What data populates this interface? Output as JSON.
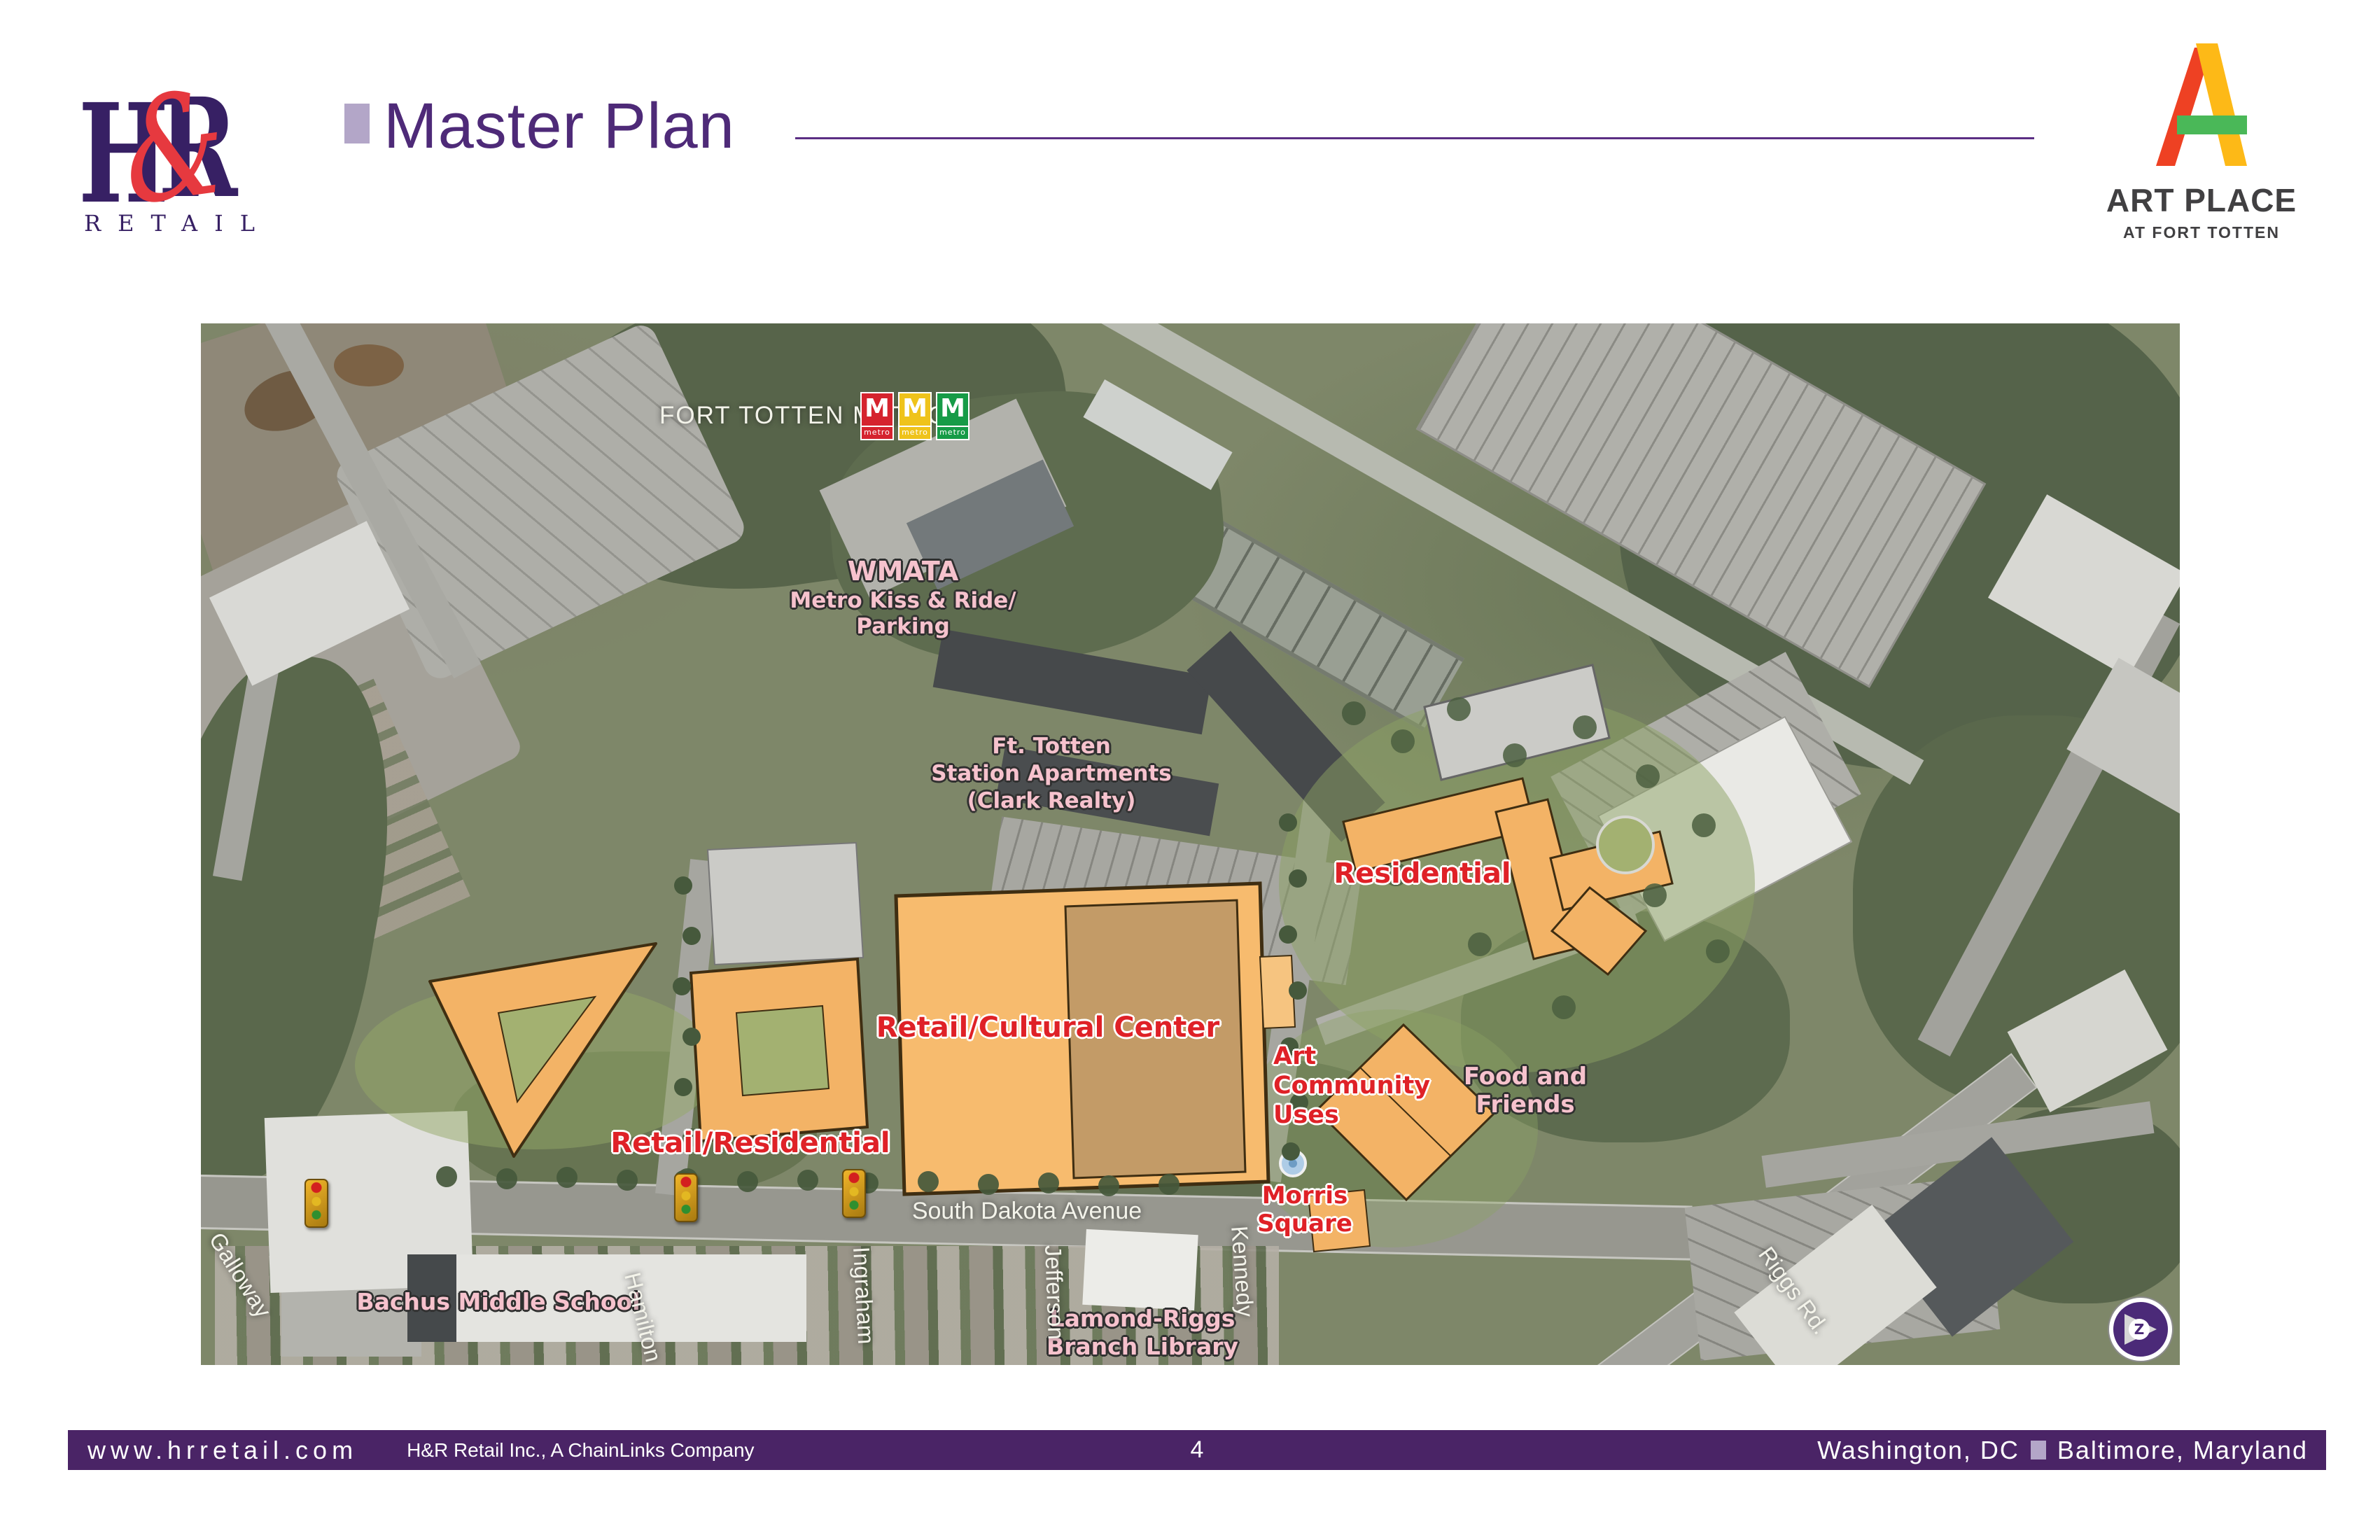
{
  "header": {
    "hr_logo": {
      "letter_h": "H",
      "ampersand": "&",
      "letter_r": "R",
      "subtext": "RETAIL"
    },
    "title": "Master Plan",
    "artplace_logo": {
      "title": "ART PLACE",
      "subtitle": "AT FORT TOTTEN"
    }
  },
  "map": {
    "labels": {
      "fort_totten_metro": "FORT TOTTEN METRO",
      "wmata_line1": "WMATA",
      "wmata_line2": "Metro Kiss & Ride/",
      "wmata_line3": "Parking",
      "station_apartments_line1": "Ft. Totten",
      "station_apartments_line2": "Station Apartments",
      "station_apartments_line3": "(Clark Realty)",
      "residential": "Residential",
      "retail_cultural_center": "Retail/Cultural Center",
      "art_community_line1": "Art Community",
      "art_community_line2": "Uses",
      "food_and_friends": "Food and Friends",
      "retail_residential": "Retail/Residential",
      "morris_square_line1": "Morris",
      "morris_square_line2": "Square",
      "south_dakota_avenue": "South Dakota Avenue",
      "bachus_middle_school": "Bachus Middle School",
      "lamond_riggs_line1": "Lamond-Riggs",
      "lamond_riggs_line2": "Branch Library"
    },
    "metro_logos": {
      "items": [
        {
          "letter": "M",
          "sub": "metro",
          "color": "#d5232e"
        },
        {
          "letter": "M",
          "sub": "metro",
          "color": "#efc31b"
        },
        {
          "letter": "M",
          "sub": "metro",
          "color": "#169b47"
        }
      ]
    },
    "streets": [
      "Galloway",
      "Hamilton",
      "Ingraham",
      "Jefferson",
      "Kennedy",
      "Riggs Rd."
    ],
    "compass_letter": "Z"
  },
  "footer": {
    "website": "www.hrretail.com",
    "company": "H&R Retail Inc., A ChainLinks Company",
    "page_number": "4",
    "location_left": "Washington, DC",
    "location_right": "Baltimore, Maryland"
  },
  "colors": {
    "footer_purple": "#4a2466",
    "title_purple": "#4e2a78",
    "bullet_lavender": "#b3a6c8",
    "hr_purple": "#372064",
    "hr_red": "#e6393f",
    "artplace_red": "#ee4123",
    "artplace_yellow": "#fdb917",
    "artplace_green": "#4ab858",
    "artplace_text": "#414042",
    "map_label_red": "#df2127",
    "map_label_pink": "#f6c2cd",
    "plan_orange": "#f3b366"
  }
}
